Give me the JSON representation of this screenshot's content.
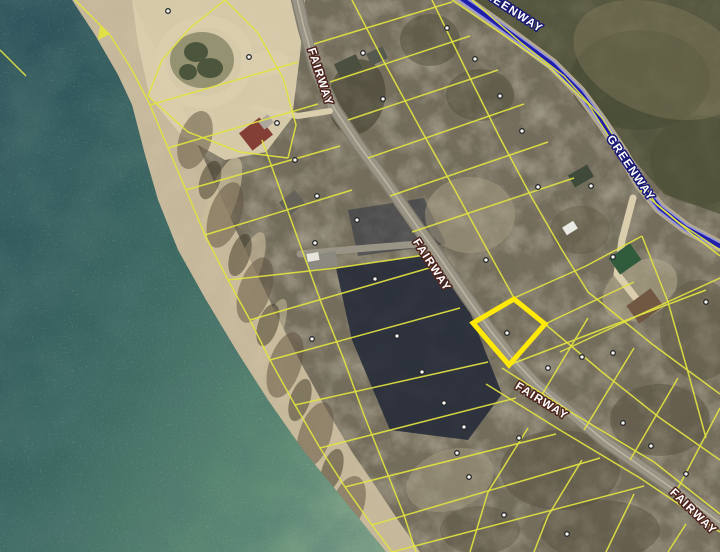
{
  "map": {
    "width": 720,
    "height": 552,
    "colors": {
      "land_base": "#71695a",
      "water_deep": "#2d4f58",
      "water_mid": "#38635d",
      "water_shallow": "#5d8871",
      "water_edge": "#7fa386",
      "sand": "#d8cba9",
      "beach": "#ccbd9c",
      "road": "#938e80",
      "road_edge": "#7b7668",
      "road_center": "#c6bfa9",
      "greenway_pavement": "#b0a58a",
      "greenway_halo": "#8f8fd8",
      "greenway_core": "#1d1da8",
      "parcel_line": "#e0e23e",
      "highlight": "#ffe808",
      "dot_fill": "#f7f7f0",
      "dot_ring": "#26262a",
      "label_fill": "#ffffff",
      "fairway_outline": "#4a221c",
      "greenway_outline": "#17176e"
    },
    "water_points": "0,0 72,0 95,35 118,75 132,105 145,155 158,200 178,250 206,300 236,350 268,400 303,450 344,500 386,552 0,552",
    "terrain_patches": [
      {
        "t": "poly",
        "pts": "72,0 95,35 118,75 132,105 145,155 158,200 178,250 206,300 236,350 268,400 303,450 344,500 386,552 420,552 398,520 378,490 352,452 328,412 302,365 278,318 256,272 236,230 218,190 200,150 184,110 166,70 148,36 132,0",
        "f": "#ccbd9c",
        "o": 0.9
      },
      {
        "t": "poly",
        "pts": "132,0 305,0 300,55 292,118 266,152 225,160 182,136 150,98 138,44",
        "f": "#d8cba9",
        "o": 0.95
      },
      {
        "t": "ell",
        "cx": 222,
        "cy": 200,
        "rx": 14,
        "ry": 45,
        "rot": 20,
        "f": "#cabb97",
        "o": 0.65
      },
      {
        "t": "ell",
        "cx": 248,
        "cy": 270,
        "rx": 12,
        "ry": 40,
        "rot": 20,
        "f": "#cabb97",
        "o": 0.6
      },
      {
        "t": "ell",
        "cx": 272,
        "cy": 332,
        "rx": 10,
        "ry": 35,
        "rot": 20,
        "f": "#cabb97",
        "o": 0.5
      },
      {
        "t": "ell",
        "cx": 195,
        "cy": 140,
        "rx": 16,
        "ry": 30,
        "rot": 18,
        "f": "#5c5140",
        "o": 0.55
      },
      {
        "t": "ell",
        "cx": 225,
        "cy": 215,
        "rx": 16,
        "ry": 34,
        "rot": 18,
        "f": "#5c5140",
        "o": 0.55
      },
      {
        "t": "ell",
        "cx": 255,
        "cy": 290,
        "rx": 16,
        "ry": 34,
        "rot": 18,
        "f": "#5c5140",
        "o": 0.55
      },
      {
        "t": "ell",
        "cx": 285,
        "cy": 365,
        "rx": 16,
        "ry": 34,
        "rot": 18,
        "f": "#5c5140",
        "o": 0.55
      },
      {
        "t": "ell",
        "cx": 315,
        "cy": 435,
        "rx": 16,
        "ry": 34,
        "rot": 18,
        "f": "#5c5140",
        "o": 0.55
      },
      {
        "t": "ell",
        "cx": 348,
        "cy": 505,
        "rx": 16,
        "ry": 30,
        "rot": 18,
        "f": "#5c5140",
        "o": 0.55
      },
      {
        "t": "ell",
        "cx": 210,
        "cy": 180,
        "rx": 10,
        "ry": 20,
        "rot": 18,
        "f": "#3f3a2c",
        "o": 0.55
      },
      {
        "t": "ell",
        "cx": 240,
        "cy": 255,
        "rx": 10,
        "ry": 22,
        "rot": 18,
        "f": "#3f3a2c",
        "o": 0.55
      },
      {
        "t": "ell",
        "cx": 268,
        "cy": 325,
        "rx": 10,
        "ry": 22,
        "rot": 18,
        "f": "#3f3a2c",
        "o": 0.55
      },
      {
        "t": "ell",
        "cx": 300,
        "cy": 400,
        "rx": 10,
        "ry": 22,
        "rot": 18,
        "f": "#3f3a2c",
        "o": 0.55
      },
      {
        "t": "ell",
        "cx": 332,
        "cy": 470,
        "rx": 10,
        "ry": 22,
        "rot": 18,
        "f": "#3f3a2c",
        "o": 0.55
      },
      {
        "t": "ell",
        "cx": 357,
        "cy": 97,
        "rx": 28,
        "ry": 38,
        "rot": 12,
        "f": "#403d2e",
        "o": 0.6
      },
      {
        "t": "poly",
        "pts": "462,0 720,0 720,214 664,194 600,122 534,48",
        "f": "#45482f",
        "o": 0.7
      },
      {
        "t": "ell",
        "cx": 640,
        "cy": 80,
        "rx": 70,
        "ry": 50,
        "rot": 0,
        "f": "#3d422c",
        "o": 0.45
      },
      {
        "t": "ell",
        "cx": 700,
        "cy": 160,
        "rx": 50,
        "ry": 45,
        "rot": 0,
        "f": "#474b32",
        "o": 0.45
      },
      {
        "t": "ell",
        "cx": 660,
        "cy": 60,
        "rx": 90,
        "ry": 55,
        "rot": 20,
        "f": "#8f8568",
        "o": 0.3
      },
      {
        "t": "poly",
        "pts": "348,210 424,198 446,244 358,256",
        "f": "#2e3140",
        "o": 0.55
      },
      {
        "t": "poly",
        "pts": "336,268 432,254 470,312 502,394 468,440 390,430 352,340",
        "f": "#242936",
        "o": 0.9
      },
      {
        "t": "ell",
        "cx": 470,
        "cy": 215,
        "rx": 45,
        "ry": 38,
        "rot": 0,
        "f": "#a99d82",
        "o": 0.45
      },
      {
        "t": "ell",
        "cx": 450,
        "cy": 480,
        "rx": 45,
        "ry": 30,
        "rot": -20,
        "f": "#ab9f84",
        "o": 0.4
      },
      {
        "t": "ell",
        "cx": 640,
        "cy": 290,
        "rx": 40,
        "ry": 28,
        "rot": -30,
        "f": "#b3a78a",
        "o": 0.5
      },
      {
        "t": "ell",
        "cx": 430,
        "cy": 40,
        "rx": 30,
        "ry": 26,
        "rot": 0,
        "f": "#4c4a38",
        "o": 0.5
      },
      {
        "t": "ell",
        "cx": 480,
        "cy": 95,
        "rx": 34,
        "ry": 26,
        "rot": 0,
        "f": "#4c4a38",
        "o": 0.5
      },
      {
        "t": "ell",
        "cx": 560,
        "cy": 470,
        "rx": 60,
        "ry": 40,
        "rot": 0,
        "f": "#4f4a3a",
        "o": 0.45
      },
      {
        "t": "ell",
        "cx": 660,
        "cy": 420,
        "rx": 50,
        "ry": 36,
        "rot": 0,
        "f": "#4f4a3a",
        "o": 0.45
      },
      {
        "t": "ell",
        "cx": 600,
        "cy": 530,
        "rx": 60,
        "ry": 30,
        "rot": 0,
        "f": "#4f4a3a",
        "o": 0.45
      },
      {
        "t": "ell",
        "cx": 480,
        "cy": 530,
        "rx": 40,
        "ry": 24,
        "rot": 0,
        "f": "#4f4a3a",
        "o": 0.4
      },
      {
        "t": "ell",
        "cx": 700,
        "cy": 330,
        "rx": 40,
        "ry": 50,
        "rot": 0,
        "f": "#56513f",
        "o": 0.45
      },
      {
        "t": "ell",
        "cx": 580,
        "cy": 230,
        "rx": 30,
        "ry": 24,
        "rot": 0,
        "f": "#57523e",
        "o": 0.4
      }
    ],
    "culdesac": {
      "ring_cx": 204,
      "ring_cy": 62,
      "ring_rx": 44,
      "ring_ry": 40,
      "ring_rot": -12,
      "island_cx": 202,
      "island_cy": 60,
      "island_rx": 32,
      "island_ry": 28,
      "island_fill": "#8f8c6d",
      "trees": [
        {
          "cx": 196,
          "cy": 52,
          "rx": 12,
          "ry": 10
        },
        {
          "cx": 210,
          "cy": 68,
          "rx": 13,
          "ry": 10
        },
        {
          "cx": 188,
          "cy": 72,
          "rx": 9,
          "ry": 8
        }
      ],
      "tree_fill": "#3f4a33",
      "pad_cx": 265,
      "pad_cy": 64,
      "pad_rx": 24,
      "pad_ry": 13,
      "pad_rot": -10
    },
    "roads": {
      "fairway_points": "296,-6 304,28 316,70 334,108 358,144 386,182 414,222 440,258 466,296 490,330 512,358 538,386 570,412 606,442 646,470 686,498 722,524",
      "spur_points": "300,254 356,249 418,244",
      "drive_ne_points": "633,198 622,240 617,274 642,306",
      "drive_house_points": "254,108 298,116 330,111",
      "greenway_points": "458,-4 492,20 522,42 552,64 580,92 602,122 622,152 640,184 660,208 686,228 720,246"
    },
    "parcel_lines": [
      "75,0 110,35 132,70 150,105 168,148 186,190 205,235 228,280 250,320 270,360 295,405 320,448 345,487 372,525 392,552",
      "262,140 282,195 302,250 322,305 344,360 364,415 384,465 404,515 416,552",
      "0,50 26,76",
      "225,0 190,28 162,60 148,96",
      "225,0 258,33 283,78 296,125 288,158",
      "148,96 188,132 240,152 288,158",
      "150,105 298,62",
      "168,148 318,104",
      "186,190 340,146",
      "205,235 352,190",
      "228,280 336,268",
      "250,320 436,266",
      "270,360 460,308",
      "295,405 488,362",
      "320,448 516,398",
      "345,487 556,434",
      "372,525 600,458",
      "392,552 644,486",
      "336,268 432,254",
      "352,0 384,62 420,128 456,192 482,240 514,298",
      "545,324 602,372 660,418 720,460",
      "432,0 466,70 500,138 532,198 562,250 588,292",
      "588,292 652,344 720,394",
      "452,0 502,34 548,66 588,104 616,148 642,192 678,222 720,250",
      "472,0 520,42 564,76 602,118 630,162 656,204 692,234 720,256",
      "314,44 452,2",
      "330,82 470,36",
      "348,120 498,70",
      "368,158 524,104",
      "390,196 548,142",
      "412,232 574,178",
      "514,298 586,266 642,236",
      "545,324 634,282",
      "509,365 616,324 706,290",
      "540,398 588,318",
      "584,430 634,348",
      "630,460 678,378",
      "676,492 720,408",
      "528,428 488,492 470,552",
      "582,460 548,516 534,552",
      "634,494 606,552",
      "686,524 668,552",
      "486,384 560,430 640,478 720,532",
      "502,368 574,414 654,462 720,514",
      "642,236 668,302 688,372 706,438",
      "560,352 650,310 720,278"
    ],
    "shore_arrow": "100,26 110,34 98,40",
    "highlight_parcel": {
      "points": "473,323 514,299 545,324 509,365",
      "dot_x": 507,
      "dot_y": 333
    },
    "dots": [
      [
        168,
        11
      ],
      [
        249,
        57
      ],
      [
        363,
        53
      ],
      [
        383,
        99
      ],
      [
        277,
        123
      ],
      [
        295,
        160
      ],
      [
        317,
        196
      ],
      [
        357,
        220
      ],
      [
        315,
        243
      ],
      [
        447,
        28
      ],
      [
        475,
        59
      ],
      [
        500,
        96
      ],
      [
        522,
        131
      ],
      [
        538,
        187
      ],
      [
        591,
        186
      ],
      [
        613,
        257
      ],
      [
        486,
        260
      ],
      [
        548,
        368
      ],
      [
        582,
        357
      ],
      [
        613,
        353
      ],
      [
        706,
        302
      ],
      [
        375,
        279
      ],
      [
        397,
        336
      ],
      [
        422,
        372
      ],
      [
        444,
        403
      ],
      [
        464,
        427
      ],
      [
        457,
        453
      ],
      [
        312,
        339
      ],
      [
        623,
        423
      ],
      [
        651,
        446
      ],
      [
        686,
        474
      ],
      [
        519,
        438
      ],
      [
        504,
        515
      ],
      [
        567,
        534
      ],
      [
        469,
        477
      ]
    ],
    "buildings": [
      {
        "cx": 256,
        "cy": 134,
        "w": 26,
        "h": 22,
        "rot": -38,
        "f": "#7d3b33"
      },
      {
        "cx": 266,
        "cy": 122,
        "w": 12,
        "h": 10,
        "rot": -38,
        "f": "#a8a298"
      },
      {
        "cx": 292,
        "cy": 203,
        "w": 20,
        "h": 17,
        "rot": -38,
        "f": "#5f5d55"
      },
      {
        "cx": 322,
        "cy": 261,
        "w": 30,
        "h": 15,
        "rot": -10,
        "f": "#85827a"
      },
      {
        "cx": 313,
        "cy": 257,
        "w": 12,
        "h": 8,
        "rot": -10,
        "f": "#e6e4da"
      },
      {
        "cx": 348,
        "cy": 66,
        "w": 24,
        "h": 15,
        "rot": -25,
        "f": "#474b3c"
      },
      {
        "cx": 377,
        "cy": 56,
        "w": 18,
        "h": 13,
        "rot": -25,
        "f": "#50544a"
      },
      {
        "cx": 581,
        "cy": 176,
        "w": 22,
        "h": 14,
        "rot": -30,
        "f": "#3c4637"
      },
      {
        "cx": 625,
        "cy": 259,
        "w": 26,
        "h": 20,
        "rot": -35,
        "f": "#2e5639"
      },
      {
        "cx": 645,
        "cy": 306,
        "w": 30,
        "h": 22,
        "rot": -36,
        "f": "#6b5340"
      },
      {
        "cx": 570,
        "cy": 228,
        "w": 13,
        "h": 9,
        "rot": -32,
        "f": "#e9e9e3"
      }
    ],
    "labels": [
      {
        "text": "FAIRWAY",
        "x": 317,
        "y": 78,
        "rotate": 72,
        "outline": "fairway_outline"
      },
      {
        "text": "FAIRWAY",
        "x": 429,
        "y": 267,
        "rotate": 57,
        "outline": "fairway_outline"
      },
      {
        "text": "FAIRWAY",
        "x": 540,
        "y": 404,
        "rotate": 32,
        "outline": "fairway_outline"
      },
      {
        "text": "FAIRWAY",
        "x": 691,
        "y": 514,
        "rotate": 44,
        "outline": "fairway_outline"
      },
      {
        "text": "GREENWAY",
        "x": 508,
        "y": 12,
        "rotate": 33,
        "outline": "greenway_outline"
      },
      {
        "text": "GREENWAY",
        "x": 628,
        "y": 170,
        "rotate": 56,
        "outline": "greenway_outline"
      }
    ]
  }
}
